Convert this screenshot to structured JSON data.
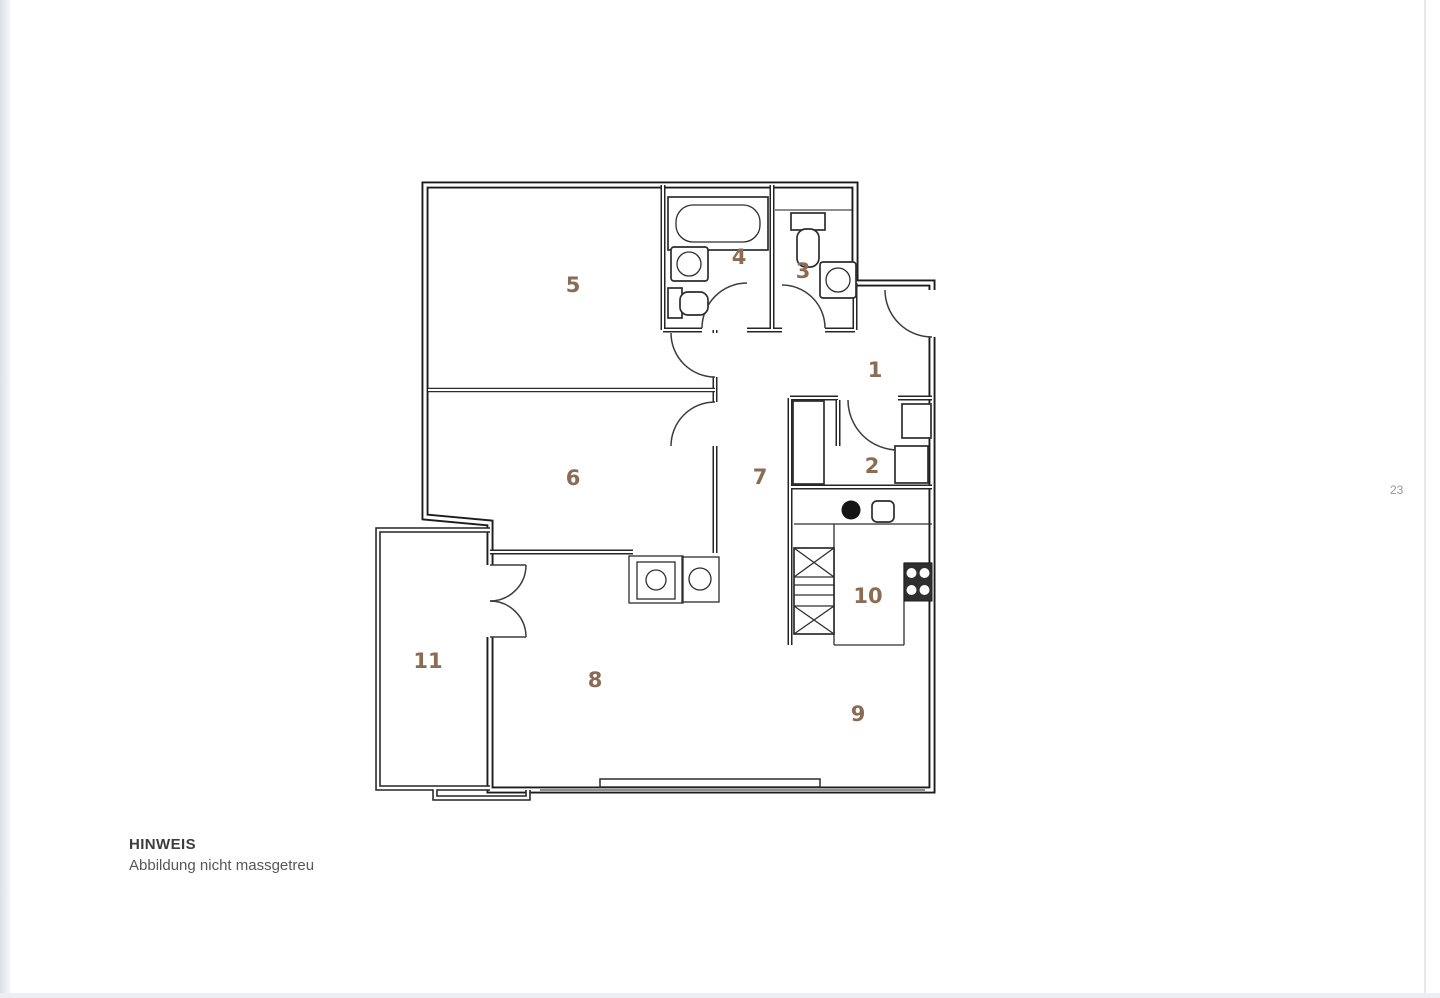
{
  "page": {
    "number": "23",
    "note": {
      "title": "HINWEIS",
      "subtitle": "Abbildung nicht massgetreu"
    }
  },
  "floor_plan": {
    "label_color": "#8a6b54",
    "rooms": [
      {
        "number": "1",
        "x": 875,
        "y": 370
      },
      {
        "number": "2",
        "x": 872,
        "y": 466
      },
      {
        "number": "3",
        "x": 803,
        "y": 271
      },
      {
        "number": "4",
        "x": 739,
        "y": 257
      },
      {
        "number": "5",
        "x": 573,
        "y": 285
      },
      {
        "number": "6",
        "x": 573,
        "y": 478
      },
      {
        "number": "7",
        "x": 760,
        "y": 477
      },
      {
        "number": "8",
        "x": 595,
        "y": 680
      },
      {
        "number": "9",
        "x": 858,
        "y": 714
      },
      {
        "number": "10",
        "x": 868,
        "y": 596
      },
      {
        "number": "11",
        "x": 428,
        "y": 661
      }
    ],
    "icons": [
      "bathtub-icon",
      "sink-icon",
      "toilet-icon",
      "washer-icon",
      "dryer-icon",
      "kitchen-sink-icon",
      "cooktop-icon",
      "tall-cabinet-icon",
      "wardrobe-icon",
      "door-swing-icon",
      "window-icon"
    ]
  }
}
